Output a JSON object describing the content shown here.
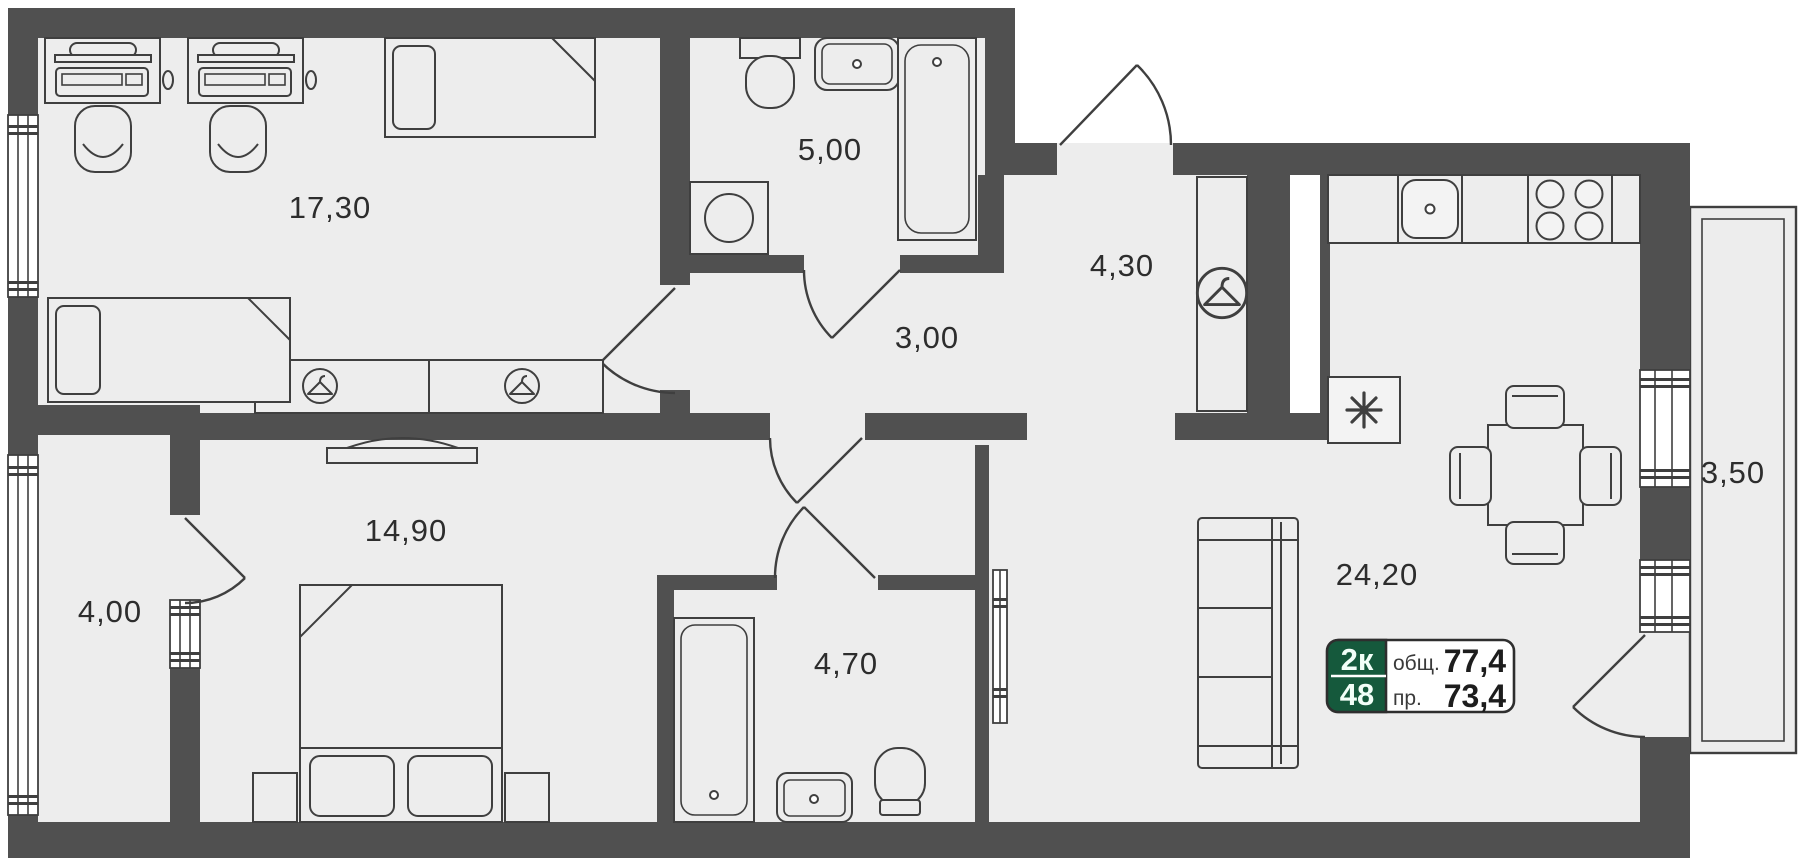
{
  "plan": {
    "rooms": {
      "office": {
        "label": "17,30"
      },
      "bathroom_top": {
        "label": "5,00"
      },
      "hall": {
        "label": "3,00"
      },
      "corridor": {
        "label": "4,30"
      },
      "kitchen_living": {
        "label": "24,20"
      },
      "bedroom": {
        "label": "14,90"
      },
      "balcony_left": {
        "label": "4,00"
      },
      "bathroom_main": {
        "label": "4,70"
      },
      "balcony_right": {
        "label": "3,50"
      }
    },
    "badge": {
      "rooms": "2к",
      "lot": "48",
      "total_label": "общ.",
      "total_value": "77,4",
      "project_label": "пр.",
      "project_value": "73,4"
    },
    "icons": {
      "hanger": "hanger-icon",
      "snowflake": "snowflake-icon"
    },
    "colors": {
      "wall": "#505050",
      "floor": "#ededed",
      "line": "#3f3f3f",
      "text": "#2d2d2d",
      "badge_green": "#15593c",
      "badge_text": "#f2fff8"
    }
  }
}
